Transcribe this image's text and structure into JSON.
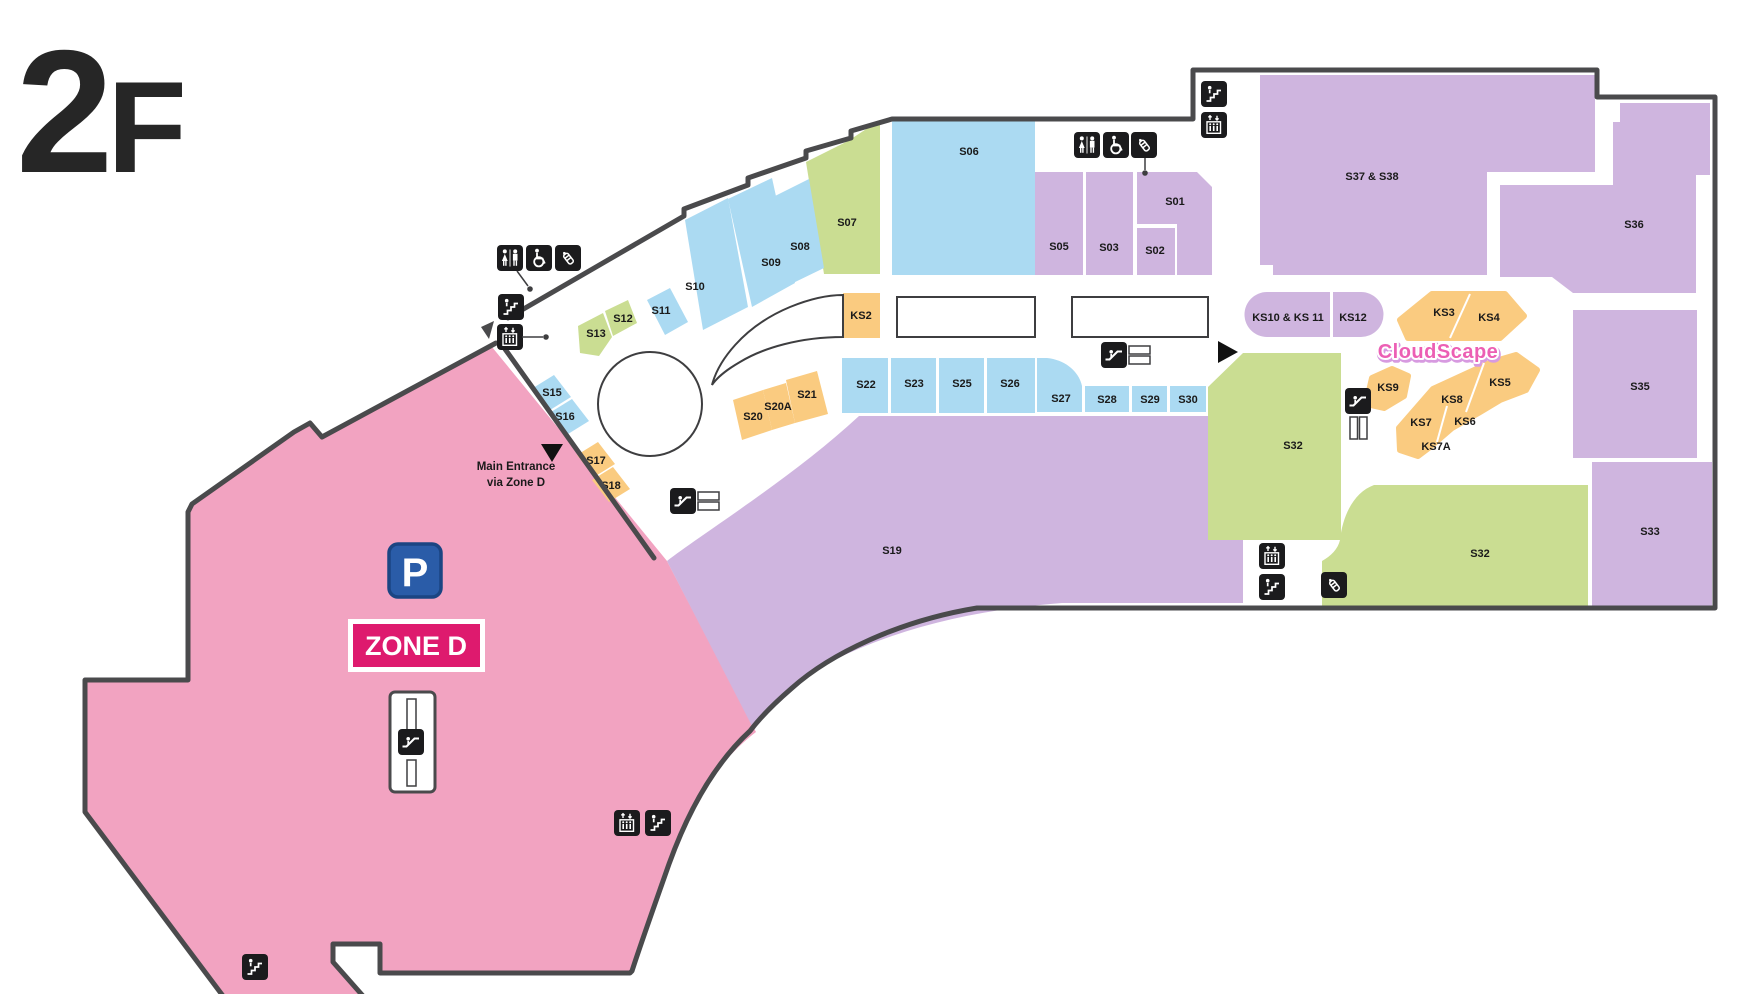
{
  "floor": {
    "title": "2F"
  },
  "zone_d": {
    "name": "ZONE D",
    "parking_label": "P"
  },
  "entrance_note": {
    "line1": "Main Entrance",
    "line2": "via Zone D"
  },
  "brand": {
    "name": "CloudScape"
  },
  "colors": {
    "anchor_purple": "#CFB5DF",
    "shop_blue": "#ABDAF2",
    "shop_green": "#CADD92",
    "kiosk_orange": "#FACB80",
    "zone_pink": "#F2A3C1",
    "wall": "#4A4A4C",
    "thin_outline": "#3E3E40",
    "badge_magenta": "#DE1A6E",
    "parking_blue": "#2A5CA8",
    "parking_border": "#1B4583",
    "brand_pink": "#EC5FB4",
    "label_ink": "#1A1A1A",
    "icon_black": "#1B1B1D"
  },
  "icon_names": {
    "toilets": "toilets-icon",
    "wheelchair": "wheelchair-accessible-icon",
    "nursing": "nursing-room-icon",
    "stairs": "stairs-icon",
    "elevator": "elevator-icon",
    "escalator": "escalator-icon",
    "hbars": "escalator-landing-icon",
    "vbars": "escalator-landing-icon",
    "arrow-down": "entrance-arrow-icon",
    "arrow-right": "entrance-arrow-icon",
    "dot": "poi-marker-dot"
  },
  "rooms": [
    {
      "id": "s01",
      "label": "S01",
      "type": "anchor_purple"
    },
    {
      "id": "s02",
      "label": "S02",
      "type": "anchor_purple"
    },
    {
      "id": "s03",
      "label": "S03",
      "type": "anchor_purple"
    },
    {
      "id": "s05",
      "label": "S05",
      "type": "anchor_purple"
    },
    {
      "id": "s06",
      "label": "S06",
      "type": "shop_blue"
    },
    {
      "id": "s07",
      "label": "S07",
      "type": "shop_green"
    },
    {
      "id": "s08",
      "label": "S08",
      "type": "shop_blue"
    },
    {
      "id": "s09",
      "label": "S09",
      "type": "shop_blue"
    },
    {
      "id": "s10",
      "label": "S10",
      "type": "shop_blue"
    },
    {
      "id": "s11",
      "label": "S11",
      "type": "shop_blue"
    },
    {
      "id": "s12",
      "label": "S12",
      "type": "shop_green"
    },
    {
      "id": "s13",
      "label": "S13",
      "type": "shop_green"
    },
    {
      "id": "s15",
      "label": "S15",
      "type": "shop_blue"
    },
    {
      "id": "s16",
      "label": "S16",
      "type": "shop_blue"
    },
    {
      "id": "s17",
      "label": "S17",
      "type": "kiosk_orange"
    },
    {
      "id": "s18",
      "label": "S18",
      "type": "kiosk_orange"
    },
    {
      "id": "s19",
      "label": "S19",
      "type": "anchor_purple"
    },
    {
      "id": "s20",
      "label": "S20",
      "type": "kiosk_orange"
    },
    {
      "id": "s20a",
      "label": "S20A",
      "type": "kiosk_orange"
    },
    {
      "id": "s21",
      "label": "S21",
      "type": "kiosk_orange"
    },
    {
      "id": "s22",
      "label": "S22",
      "type": "shop_blue"
    },
    {
      "id": "s23",
      "label": "S23",
      "type": "shop_blue"
    },
    {
      "id": "s25",
      "label": "S25",
      "type": "shop_blue"
    },
    {
      "id": "s26",
      "label": "S26",
      "type": "shop_blue"
    },
    {
      "id": "s27",
      "label": "S27",
      "type": "shop_blue"
    },
    {
      "id": "s28",
      "label": "S28",
      "type": "shop_blue"
    },
    {
      "id": "s29",
      "label": "S29",
      "type": "shop_blue"
    },
    {
      "id": "s30",
      "label": "S30",
      "type": "shop_blue"
    },
    {
      "id": "s32_upper",
      "label": "S32",
      "type": "shop_green"
    },
    {
      "id": "s32_lower",
      "label": "S32",
      "type": "shop_green"
    },
    {
      "id": "s33",
      "label": "S33",
      "type": "anchor_purple"
    },
    {
      "id": "s35",
      "label": "S35",
      "type": "anchor_purple"
    },
    {
      "id": "s36",
      "label": "S36",
      "type": "anchor_purple"
    },
    {
      "id": "s37_38",
      "label": "S37 & S38",
      "type": "anchor_purple"
    },
    {
      "id": "ks2",
      "label": "KS2",
      "type": "kiosk_orange"
    },
    {
      "id": "ks3",
      "label": "KS3",
      "type": "kiosk_orange"
    },
    {
      "id": "ks4",
      "label": "KS4",
      "type": "kiosk_orange"
    },
    {
      "id": "ks5",
      "label": "KS5",
      "type": "kiosk_orange"
    },
    {
      "id": "ks6",
      "label": "KS6",
      "type": "kiosk_orange"
    },
    {
      "id": "ks7",
      "label": "KS7",
      "type": "kiosk_orange"
    },
    {
      "id": "ks7a",
      "label": "KS7A",
      "type": "kiosk_orange"
    },
    {
      "id": "ks8",
      "label": "KS8",
      "type": "kiosk_orange"
    },
    {
      "id": "ks9",
      "label": "KS9",
      "type": "kiosk_orange"
    },
    {
      "id": "ks10_11",
      "label": "KS10 & KS 11",
      "type": "anchor_purple"
    },
    {
      "id": "ks12",
      "label": "KS12",
      "type": "anchor_purple"
    }
  ]
}
